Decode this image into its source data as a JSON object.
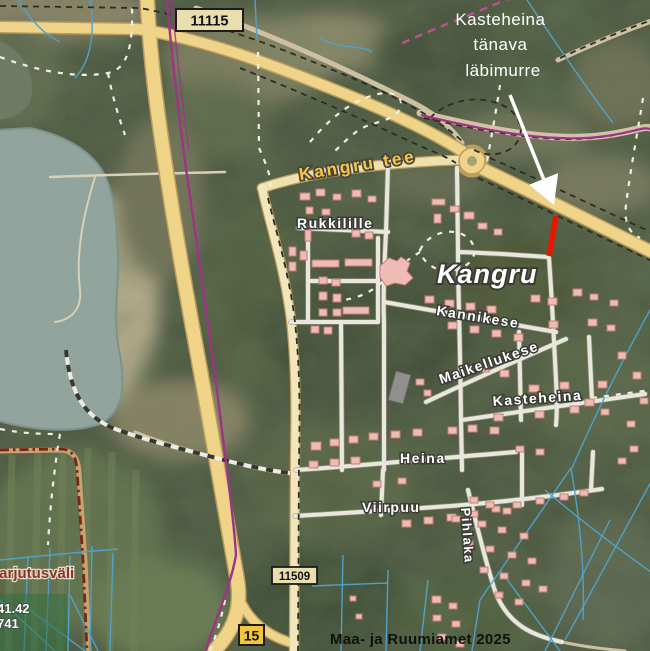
{
  "map": {
    "place_label": "Kangru",
    "street_labels": {
      "kangru_tee": "Kangru tee",
      "rukkilille": "Rukkilille",
      "kannikese": "Kannikese",
      "maikellukese": "Maikellukese",
      "kasteheina": "Kasteheina",
      "heina": "Heina",
      "viirpuu": "Viirpuu",
      "pihlaka": "Pihlaka"
    },
    "area_labels": {
      "training_ground": "harjutusväli",
      "parcel_number_1": "41.42",
      "parcel_number_2": "741"
    },
    "route_badges": {
      "badge_11115": "11115",
      "badge_11509": "11509",
      "badge_15": "15"
    }
  },
  "annotation": {
    "lines": [
      "Kasteheina",
      "tänava",
      "läbimurre"
    ]
  },
  "attribution": "Maa- ja Ruumiamet 2025",
  "colors": {
    "road_major_fill": "#f2d586",
    "road_minor_fill": "#f4e8bd",
    "road_casing": "#bb9c58",
    "village_road": "#eceade",
    "road_number_badge_bg": "#e9dfae",
    "road_15_badge_bg": "#f2c53d",
    "building_fill": "#f2bcb4",
    "building_stroke": "#c47b74",
    "water": "#8fa39b",
    "highlight_red": "#e81600",
    "boundary_dark_red": "#7c1a12",
    "ditch_blue": "#4aa0c8",
    "purple_line": "#9c2d86",
    "magenta_dashed": "#c04898",
    "overlay_green": "#2d6e3c",
    "annotation_text": "#ffffff",
    "street_label_fill": "#ffffff",
    "road_label_fill": "#f6c945"
  }
}
